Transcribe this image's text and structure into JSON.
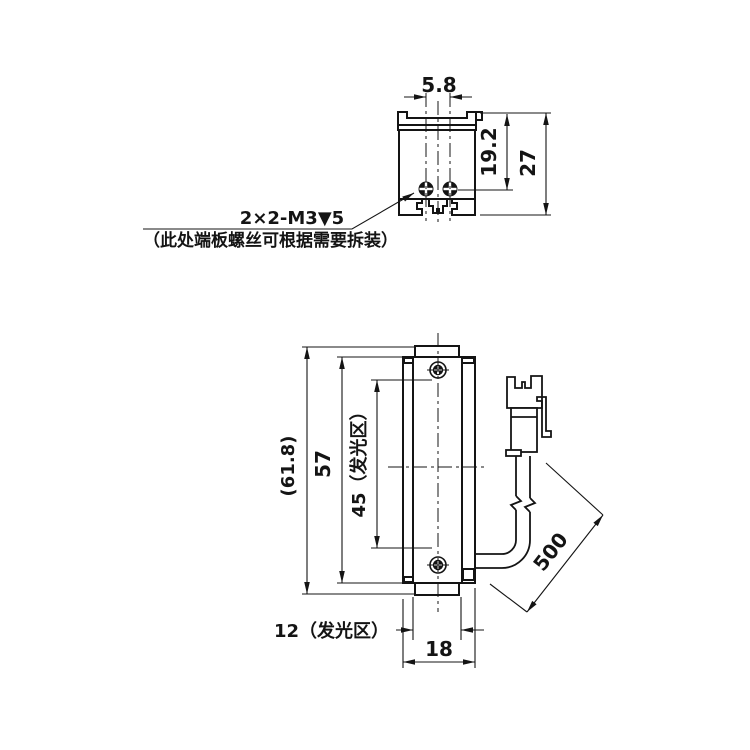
{
  "colors": {
    "background": "#ffffff",
    "line": "#141414"
  },
  "top_view": {
    "screw_spacing": "5.8",
    "screw_to_top": "19.2",
    "overall_height": "27",
    "thread_callout": "2×2-M3▼5",
    "note": "（此处端板螺丝可根据需要拆装）"
  },
  "front_view": {
    "overall_length": "(61.8)",
    "body_length": "57",
    "emitting_length": "45（发光区）",
    "emitting_width": "12（发光区）",
    "body_width": "18",
    "cable_length": "500"
  }
}
